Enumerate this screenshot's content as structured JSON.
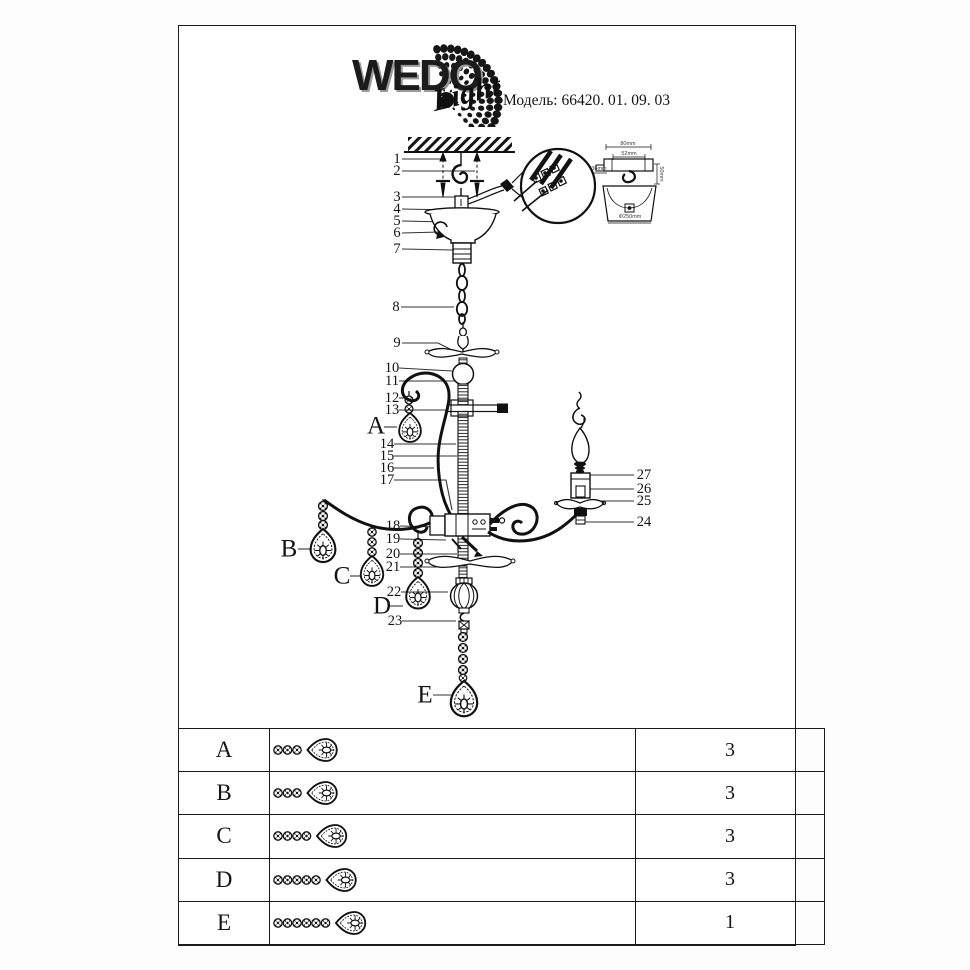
{
  "header": {
    "brand": "WEDO",
    "brand_script": "Light",
    "model_label": "Модель:",
    "model_value": "66420. 01. 09. 03"
  },
  "diagram": {
    "callouts": {
      "1": "1",
      "2": "2",
      "3": "3",
      "4": "4",
      "5": "5",
      "6": "6",
      "7": "7",
      "8": "8",
      "9": "9",
      "10": "10",
      "11": "11",
      "12": "12",
      "13": "13",
      "14": "14",
      "15": "15",
      "16": "16",
      "17": "17",
      "18": "18",
      "19": "19",
      "20": "20",
      "21": "21",
      "22": "22",
      "23": "23",
      "24": "24",
      "25": "25",
      "26": "26",
      "27": "27",
      "A": "A",
      "B": "B",
      "C": "C",
      "D": "D",
      "E": "E"
    },
    "detail_dims": {
      "width_outer": "80mm",
      "width_inner": "52mm",
      "screw": "36mm",
      "height": "50mm",
      "canopy": "Φ250mm"
    }
  },
  "parts_table": {
    "rows": [
      {
        "letter": "A",
        "qty": "3",
        "icon_beads": 3
      },
      {
        "letter": "B",
        "qty": "3",
        "icon_beads": 3
      },
      {
        "letter": "C",
        "qty": "3",
        "icon_beads": 4
      },
      {
        "letter": "D",
        "qty": "3",
        "icon_beads": 5
      },
      {
        "letter": "E",
        "qty": "1",
        "icon_beads": 6
      }
    ]
  }
}
